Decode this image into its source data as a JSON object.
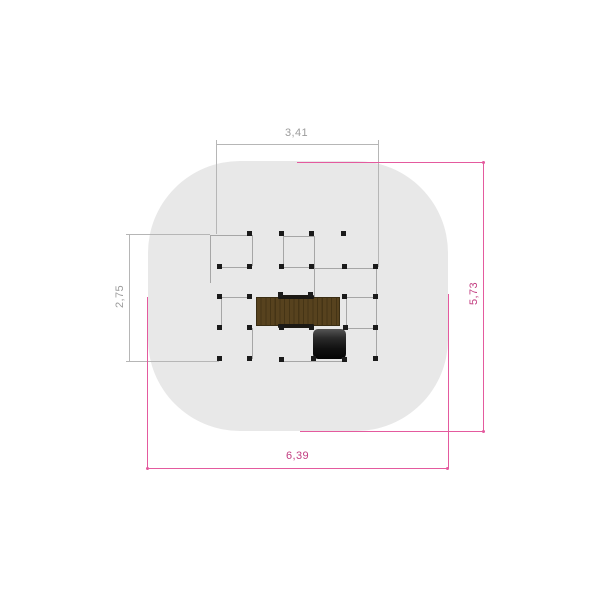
{
  "title": "Playground equipment plan view with safety zone dimensions",
  "labels": {
    "structure_width": "3,41",
    "structure_height": "2,75",
    "zone_height": "5,73",
    "zone_width": "6,39"
  },
  "colors": {
    "background": "#ffffff",
    "zone_fill": "#e8e8e8",
    "frame_line": "#a6a6a6",
    "post": "#1a1a1a",
    "wood": "#57421e",
    "wood_dark": "#453415",
    "rail": "#1c1914",
    "tunnel_dark": "#040404",
    "dim_gray_line": "#b6b6b6",
    "dim_gray_text": "#9c9c9c",
    "dim_pink_line": "#e45a9e",
    "dim_pink_text": "#c23d80"
  },
  "drawing": {
    "canvas": {
      "w": 600,
      "h": 600
    },
    "safety_zone": {
      "x": 147.5,
      "y": 161,
      "w": 300,
      "h": 270
    },
    "frame_lines": [
      [
        209.5,
        235,
        251.5,
        235
      ],
      [
        209.5,
        235,
        209.5,
        283
      ],
      [
        251.5,
        235,
        251.5,
        266
      ],
      [
        219,
        266.5,
        251.5,
        266.5
      ],
      [
        283,
        235.5,
        313.5,
        235.5
      ],
      [
        283,
        235.5,
        283,
        267
      ],
      [
        313.5,
        235.5,
        313.5,
        296.5
      ],
      [
        283,
        266.5,
        313.5,
        266.5
      ],
      [
        313.5,
        267.5,
        375.5,
        267.5
      ],
      [
        375.5,
        267.5,
        375.5,
        358.5
      ],
      [
        219,
        297,
        250,
        297
      ],
      [
        220.5,
        297,
        220.5,
        327.5
      ],
      [
        344,
        297,
        375.5,
        297
      ],
      [
        345.5,
        297,
        345.5,
        327.5
      ],
      [
        345.5,
        328,
        375.5,
        328
      ],
      [
        251.5,
        327.5,
        251.5,
        358.5
      ],
      [
        281,
        360.5,
        345.5,
        360.5
      ]
    ],
    "platform_rects": [
      {
        "x": 255.5,
        "y": 297,
        "w": 84,
        "h": 29,
        "cls": "wood",
        "name": "wood-deck-platform"
      },
      {
        "x": 277.5,
        "y": 294.5,
        "w": 36,
        "h": 4.5,
        "cls": "rail",
        "name": "platform-rail-top"
      },
      {
        "x": 277.5,
        "y": 323.5,
        "w": 36,
        "h": 4.5,
        "cls": "rail",
        "name": "platform-rail-bottom"
      },
      {
        "x": 312.5,
        "y": 328.5,
        "w": 33,
        "h": 30,
        "cls": "tunnel",
        "name": "crawl-tunnel"
      }
    ],
    "posts": [
      [
        249.5,
        233
      ],
      [
        281,
        233
      ],
      [
        311.5,
        233
      ],
      [
        343.5,
        233
      ],
      [
        219,
        266
      ],
      [
        249.5,
        266
      ],
      [
        281,
        266
      ],
      [
        311.5,
        266
      ],
      [
        344,
        266
      ],
      [
        375.5,
        266
      ],
      [
        219,
        296.5
      ],
      [
        249.5,
        296.5
      ],
      [
        280,
        294.5
      ],
      [
        310.5,
        294.5
      ],
      [
        344,
        296.5
      ],
      [
        375.5,
        296.5
      ],
      [
        219,
        327.3
      ],
      [
        249.5,
        327.3
      ],
      [
        281,
        327.3
      ],
      [
        311.5,
        327.3
      ],
      [
        345,
        327.3
      ],
      [
        375.5,
        327.3
      ],
      [
        219,
        358.5
      ],
      [
        249.5,
        358.5
      ],
      [
        281,
        359
      ],
      [
        313,
        358.5
      ],
      [
        344.5,
        359
      ],
      [
        375.5,
        358.5
      ]
    ],
    "dim_lines_gray": [
      [
        215.5,
        143.5,
        377.5,
        143.5
      ],
      [
        215.5,
        143.5,
        215.5,
        233.5
      ],
      [
        377.5,
        143.5,
        377.5,
        267
      ],
      [
        215.5,
        140,
        215.5,
        147
      ],
      [
        377.5,
        140,
        377.5,
        147
      ],
      [
        129,
        233.5,
        129,
        360.5
      ],
      [
        129,
        233.5,
        209.5,
        233.5
      ],
      [
        129,
        360.5,
        219,
        360.5
      ],
      [
        125.5,
        233.5,
        132.5,
        233.5
      ],
      [
        125.5,
        360.5,
        132.5,
        360.5
      ]
    ],
    "dim_lines_pink": [
      [
        147,
        468,
        447.5,
        468
      ],
      [
        147,
        296.5,
        147,
        468
      ],
      [
        447.5,
        294,
        447.5,
        468
      ],
      [
        483,
        162,
        483,
        431
      ],
      [
        297,
        162,
        483,
        162
      ],
      [
        300,
        431,
        483,
        431
      ]
    ],
    "dim_dots": [
      [
        147,
        468
      ],
      [
        447.5,
        468
      ],
      [
        483,
        162
      ],
      [
        483,
        431
      ]
    ]
  }
}
